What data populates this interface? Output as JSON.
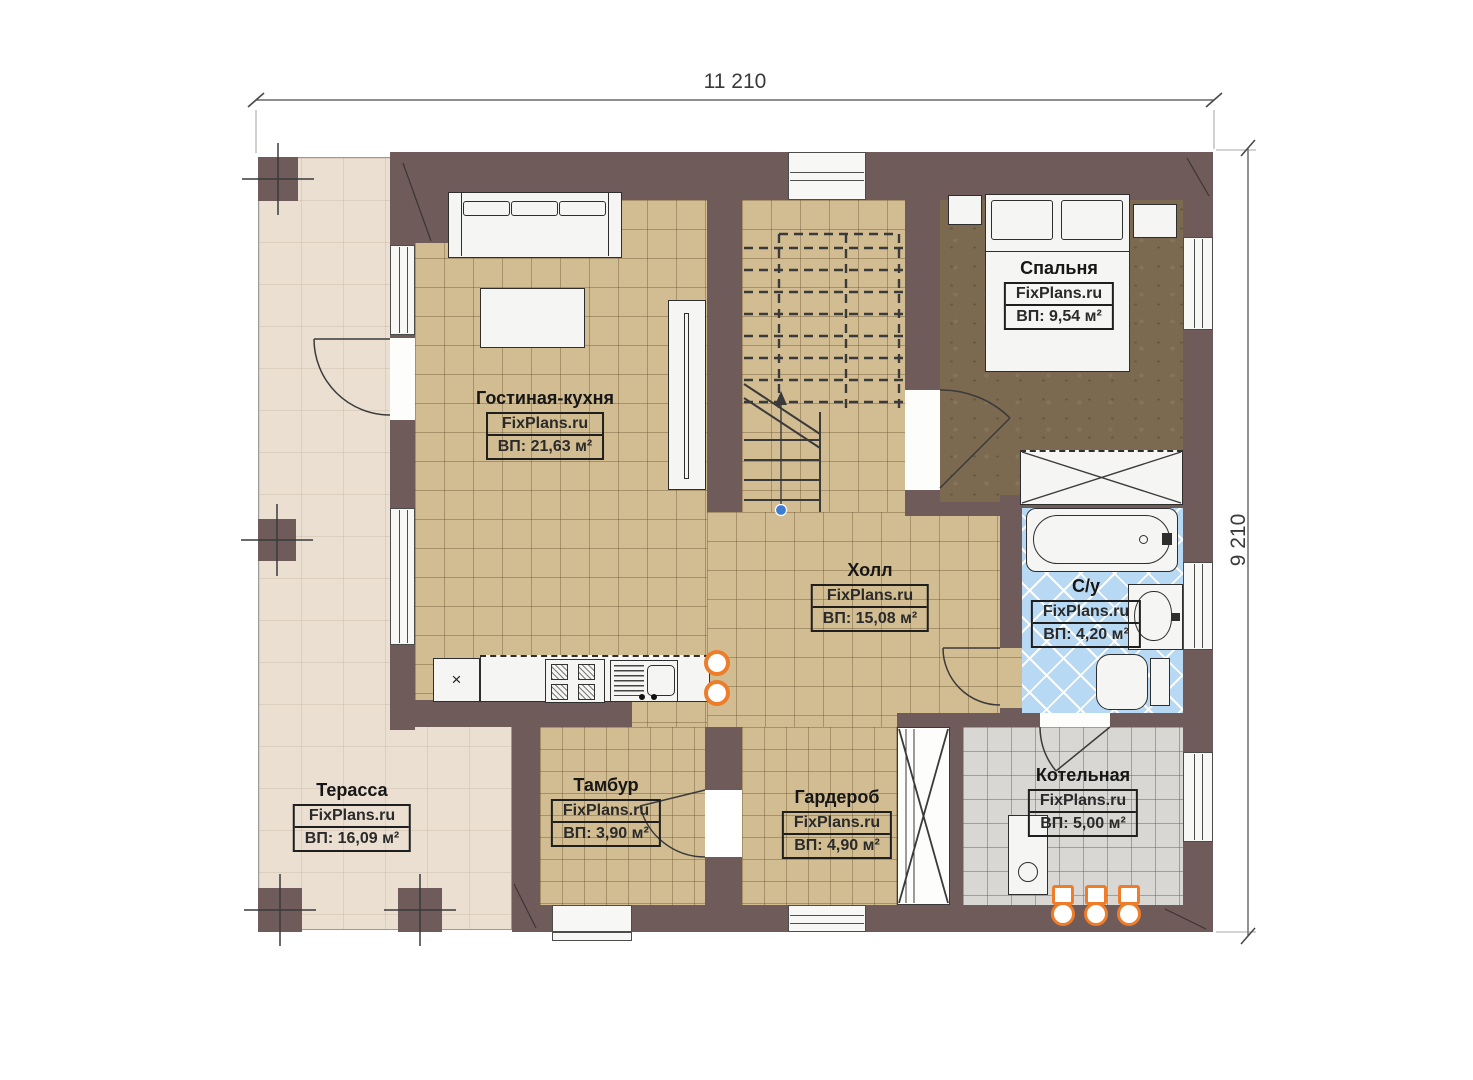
{
  "brand": "FixPlans.ru",
  "dimension_labels": {
    "top": "11 210",
    "right": "9 210"
  },
  "rooms": {
    "living": {
      "name": "Гостиная-кухня",
      "brand": "FixPlans.ru",
      "area": "ВП: 21,63 м²"
    },
    "bedroom": {
      "name": "Спальня",
      "brand": "FixPlans.ru",
      "area": "ВП: 9,54 м²"
    },
    "hall": {
      "name": "Холл",
      "brand": "FixPlans.ru",
      "area": "ВП: 15,08 м²"
    },
    "bathroom": {
      "name": "С/у",
      "brand": "FixPlans.ru",
      "area": "ВП: 4,20 м²"
    },
    "vestibule": {
      "name": "Тамбур",
      "brand": "FixPlans.ru",
      "area": "ВП: 3,90 м²"
    },
    "wardrobe": {
      "name": "Гардероб",
      "brand": "FixPlans.ru",
      "area": "ВП: 4,90 м²"
    },
    "boiler": {
      "name": "Котельная",
      "brand": "FixPlans.ru",
      "area": "ВП: 5,00 м²"
    },
    "terrace": {
      "name": "Терасса",
      "brand": "FixPlans.ru",
      "area": "ВП: 16,09 м²"
    }
  },
  "icons": {
    "fridge_mark": "×"
  },
  "colors": {
    "wall": "#6f5b5a",
    "floor_tile": "#d2bd92",
    "bedroom_floor": "#7b6950",
    "bathroom_tile": "#b8d9f4",
    "boiler_tile": "#d8d7d4",
    "terrace_floor": "#eadfd0",
    "pipe_accent": "#ed7d2b",
    "stair_marker": "#3d7cd0"
  }
}
